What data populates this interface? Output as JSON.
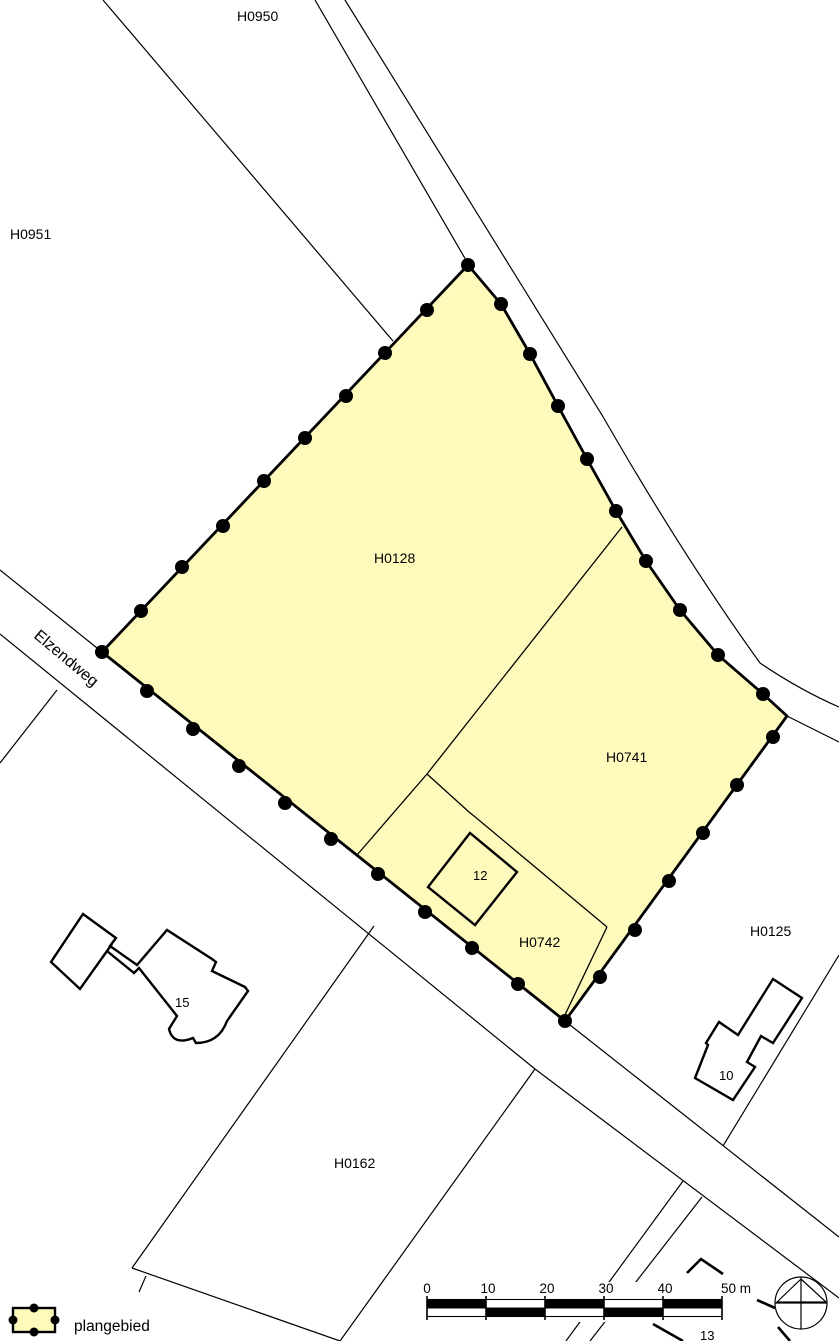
{
  "map_type": "cadastral plan map",
  "colors": {
    "plangebied_fill": "#FDFABC",
    "line": "#000000",
    "background": "#FFFFFF"
  },
  "street": {
    "name": "Elzendweg"
  },
  "parcel_labels": {
    "h0950": "H0950",
    "h0951": "H0951",
    "h0128": "H0128",
    "h0741": "H0741",
    "h0742": "H0742",
    "h0125": "H0125",
    "h0162": "H0162"
  },
  "house_numbers": {
    "h12": "12",
    "h15": "15",
    "h10": "10",
    "h13": "13"
  },
  "legend": {
    "label": "plangebied"
  },
  "scale_bar": {
    "labels": [
      "0",
      "10",
      "20",
      "30",
      "40",
      "50 m"
    ]
  }
}
